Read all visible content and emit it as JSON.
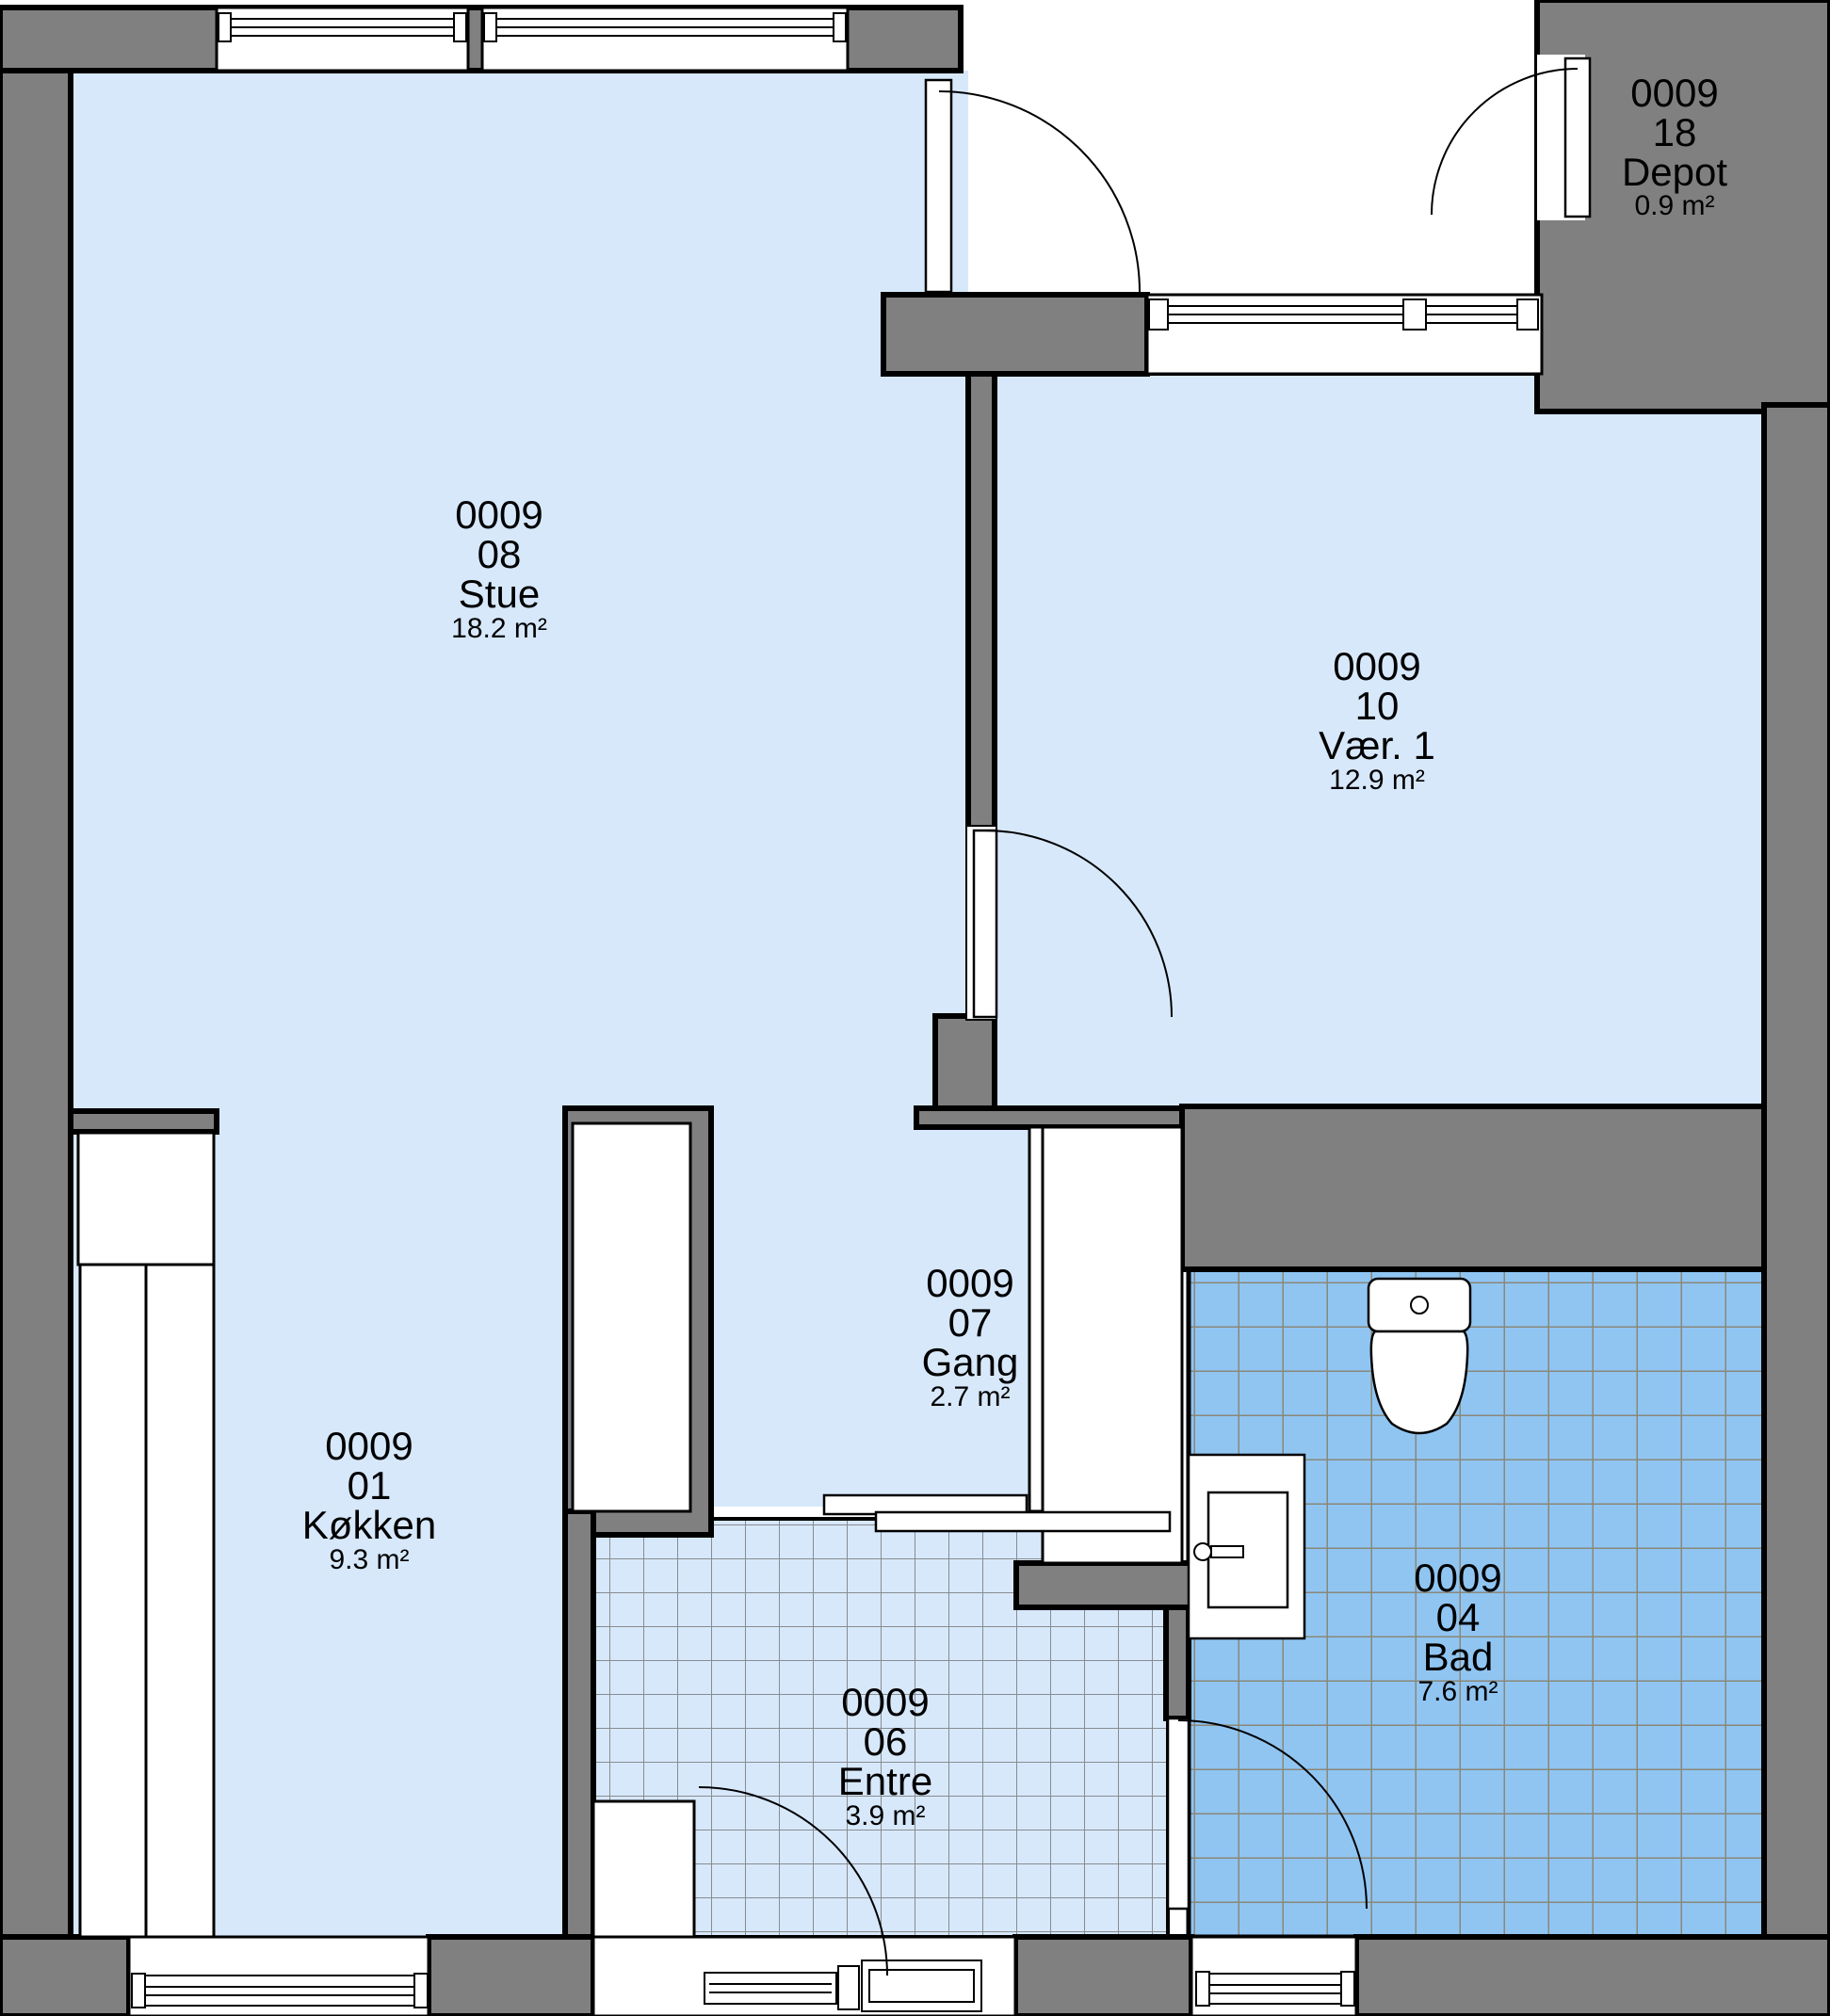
{
  "floorplan": {
    "rooms": {
      "stue": {
        "project": "0009",
        "number": "08",
        "name": "Stue",
        "area": "18.2 m²"
      },
      "vaer1": {
        "project": "0009",
        "number": "10",
        "name": "Vær. 1",
        "area": "12.9 m²"
      },
      "depot": {
        "project": "0009",
        "number": "18",
        "name": "Depot",
        "area": "0.9 m²"
      },
      "gang": {
        "project": "0009",
        "number": "07",
        "name": "Gang",
        "area": "2.7 m²"
      },
      "koekken": {
        "project": "0009",
        "number": "01",
        "name": "Køkken",
        "area": "9.3 m²"
      },
      "entre": {
        "project": "0009",
        "number": "06",
        "name": "Entre",
        "area": "3.9 m²"
      },
      "bad": {
        "project": "0009",
        "number": "04",
        "name": "Bad",
        "area": "7.6 m²"
      }
    },
    "colors": {
      "wall_fill": "#808080",
      "outline": "#000000",
      "room_fill": "#d7e8fb",
      "bath_tile_fill": "#90c5f2",
      "bath_tile_line": "#8a8878",
      "entre_tile_line": "#888c90",
      "fixture_fill": "#ffffff"
    },
    "fixtures": [
      "toilet",
      "washbasin",
      "kitchen-counter",
      "wardrobe",
      "wardrobe-entre"
    ]
  }
}
